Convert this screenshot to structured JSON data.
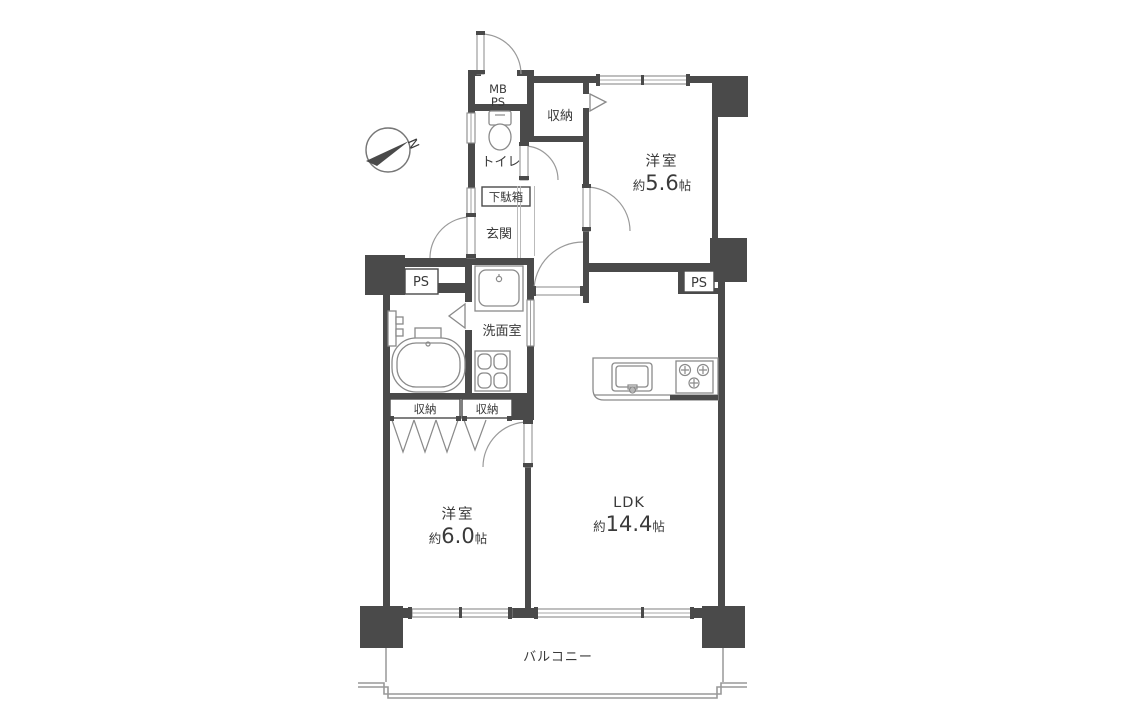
{
  "plan": {
    "type": "apartment-floor-plan",
    "colors": {
      "wall": "#4a4a4a",
      "fixture_line": "#8a8a8a",
      "text": "#3a3a3a",
      "background": "#ffffff"
    },
    "compass": {
      "north_label": "N"
    },
    "rooms": {
      "bedroom1": {
        "name": "洋室",
        "size_prefix": "約",
        "size_value": "5.6",
        "size_unit": "帖"
      },
      "bedroom2": {
        "name": "洋室",
        "size_prefix": "約",
        "size_value": "6.0",
        "size_unit": "帖"
      },
      "ldk": {
        "name": "LDK",
        "size_prefix": "約",
        "size_value": "14.4",
        "size_unit": "帖"
      },
      "entrance": {
        "name": "玄関"
      },
      "toilet": {
        "name": "トイレ"
      },
      "washroom": {
        "name": "洗面室"
      },
      "balcony": {
        "name": "バルコニー"
      },
      "shoe_cabinet": {
        "name": "下駄箱"
      },
      "closet_top": {
        "name": "収納"
      },
      "closet_left": {
        "name": "収納"
      },
      "closet_right": {
        "name": "収納"
      },
      "meter_box": {
        "line1": "MB",
        "line2": "PS"
      },
      "pipe_space_left": {
        "name": "PS"
      },
      "pipe_space_right": {
        "name": "PS"
      }
    }
  }
}
